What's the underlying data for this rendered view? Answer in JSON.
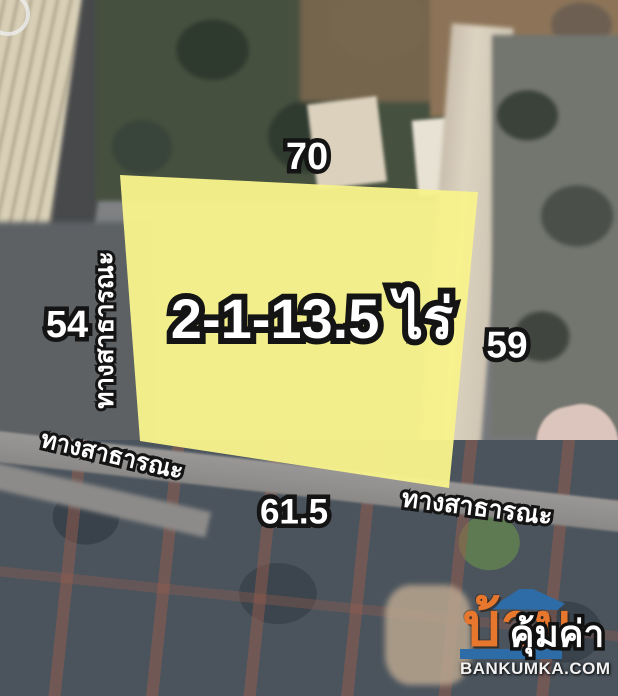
{
  "map": {
    "plot": {
      "area_label": "2-1-13.5 ไร่",
      "fill_color": "#F7F28B"
    },
    "dimensions": {
      "top": "70",
      "left": "54",
      "right": "59",
      "bottom": "61.5"
    },
    "roads": {
      "left_vertical": "ทางสาธารณะ",
      "bottom_left": "ทางสาธารณะ",
      "bottom_right": "ทางสาธารณะ"
    },
    "label_colors": {
      "fill": "#FFFFFF",
      "outline": "#141414"
    }
  },
  "watermark": {
    "brand_thai": "บ้าน",
    "brand_overlay": "คุ้มค่า",
    "website": "BANKUMKA.COM",
    "orange": "#E8772E",
    "blue": "#2E6CA8"
  }
}
